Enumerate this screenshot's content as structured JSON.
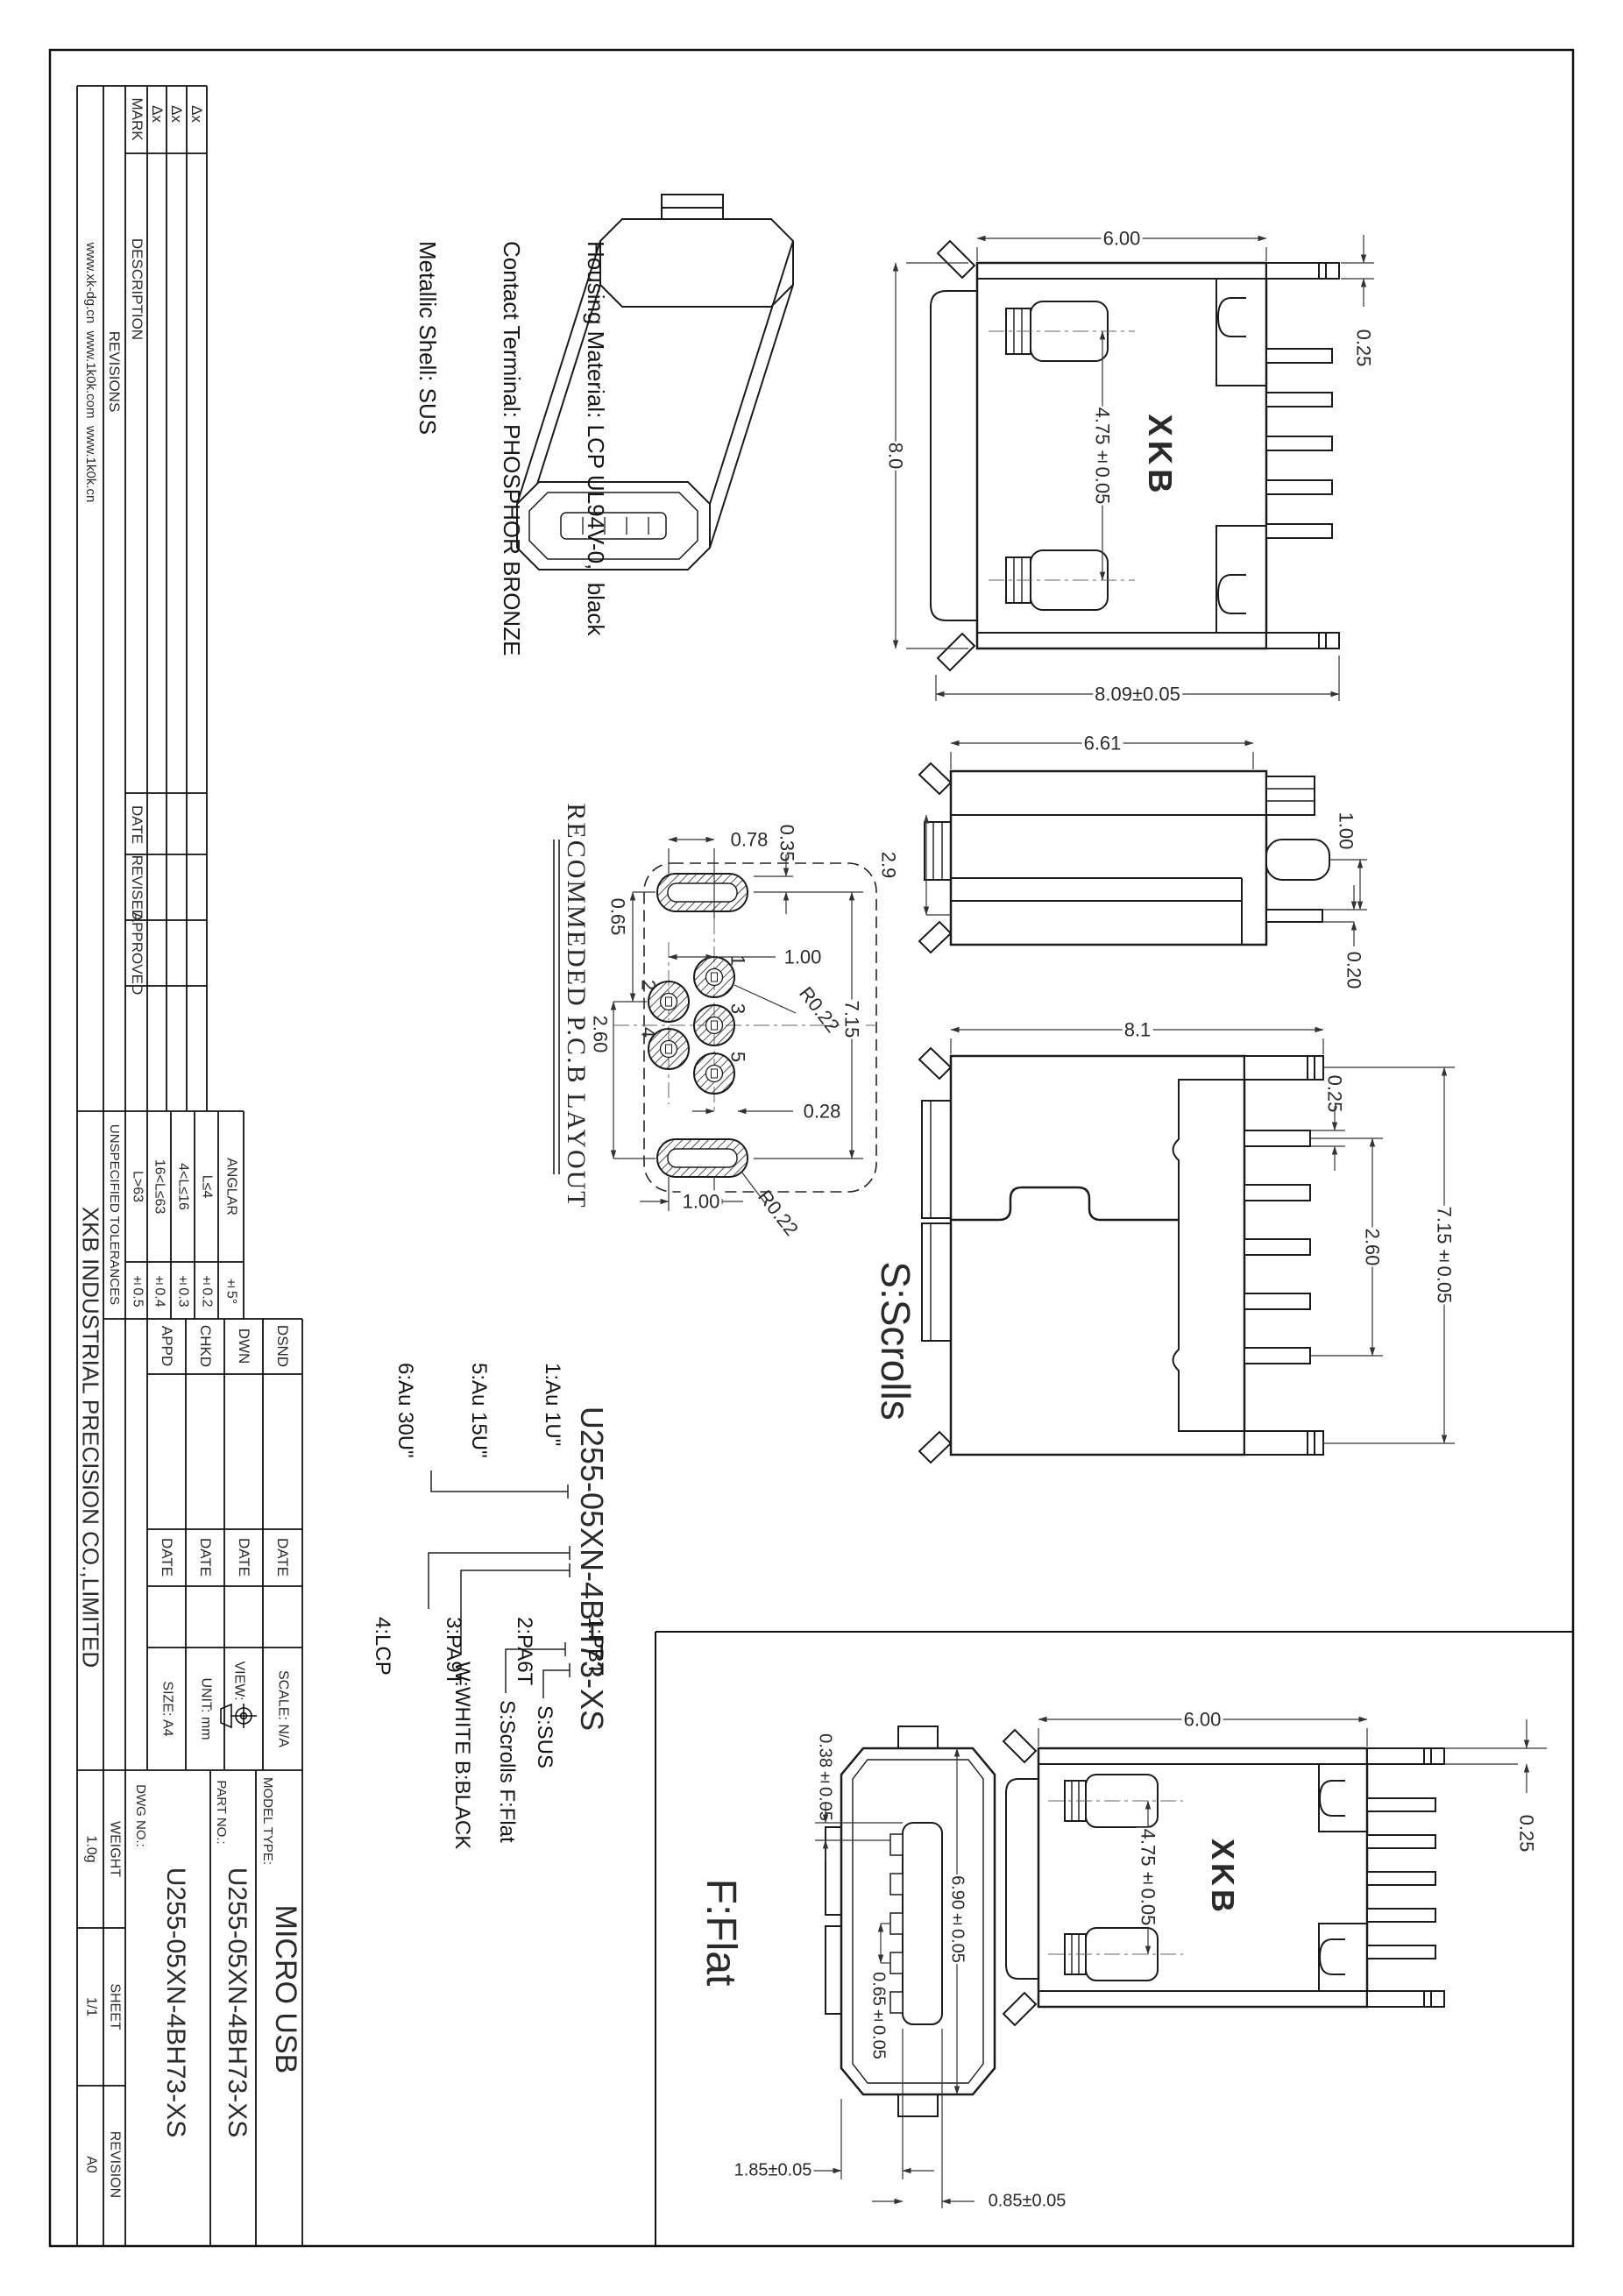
{
  "sheet": {
    "websites": "www.xk-dg.cn  www.1k0k.com  www.1k0k.cn",
    "revisions_title": "REVISIONS",
    "rev": {
      "mark": "MARK",
      "description": "DESCRIPTION",
      "date": "DATE",
      "revised": "REVISED",
      "approved": "APPROVED",
      "marks": [
        "Δx",
        "Δx",
        "Δx"
      ]
    },
    "tol": {
      "title": "UNSPECIFIED TOLERANCES",
      "l63": "L>63",
      "v63": "±0.5",
      "l1663": "16<L≤63",
      "v1663": "±0.4",
      "l416": "4<L≤16",
      "v416": "±0.3",
      "l4": "L≤4",
      "v4": "±0.2",
      "ang": "ANGLAR",
      "vang": "±5°"
    },
    "sig": {
      "dsnd": "DSND",
      "dwn": "DWN",
      "chkd": "CHKD",
      "appd": "APPD",
      "date": "DATE"
    },
    "info": {
      "scale": "SCALE: N/A",
      "view": "VIEW:",
      "unit": "UNIT: mm",
      "size": "SIZE: A4"
    },
    "tb": {
      "company": "XKB INDUSTRIAL PRECISION CO.,LIMITED",
      "model_label": "MODEL TYPE:",
      "model": "MICRO USB",
      "part_label": "PART NO.:",
      "part": "U255-05XN-4BH73-XS",
      "dwg_label": "DWG NO.:",
      "dwg": "U255-05XN-4BH73-XS",
      "weight_label": "WEIGHT",
      "weight": "1.0g",
      "sheet_label": "SHEET",
      "sheet": "1/1",
      "rev_label": "REVISION",
      "rev": "A0"
    }
  },
  "notes": {
    "l1": "Housing Material: LCP UL94V-0,  black",
    "l2": "Contact Terminal: PHOSPHOR BRONZE",
    "l3": "Metallic Shell: SUS"
  },
  "labels": {
    "scrolls": "S:Scrolls",
    "flat": "F:Flat",
    "logo": "XKB",
    "pcb_title": "RECOMMEDED P.C.B LAYOUT"
  },
  "front_view": {
    "w": "6.00",
    "h": "8.0",
    "t": "0.25",
    "pitch": "4.75±0.05",
    "w2": "8.09±0.05"
  },
  "side_view": {
    "l": "6.61",
    "h": "2.9",
    "d1": "1.00",
    "d2": "0.20"
  },
  "top_view": {
    "w": "8.1",
    "t": "0.25",
    "pitch": "2.60",
    "span": "7.15±0.05"
  },
  "pcb": {
    "d1": "0.78",
    "d2": "0.35",
    "d3": "0.65",
    "d4": "1.00",
    "d5": "2.60",
    "r1": "R0.22",
    "d6": "7.15",
    "d7": "0.28",
    "d8": "1.00",
    "r2": "R0.22",
    "p1": "1",
    "p2": "2",
    "p3": "3",
    "p4": "4",
    "p5": "5"
  },
  "flat_face": {
    "t": "0.38±0.05",
    "h": "6.90±0.05",
    "pitch": "0.65±0.05",
    "a": "1.85±0.05",
    "b": "0.85±0.05"
  },
  "flat_front": {
    "w": "6.00",
    "t": "0.25",
    "pitch": "4.75±0.05"
  },
  "breakdown": {
    "part": "U255-05XN-4BH73-XS",
    "au1": "1:Au 1U\"",
    "au5": "5:Au 15U\"",
    "au6": "6:Au 30U\"",
    "m1": "1:PBT",
    "m2": "2:PA6T",
    "m3": "3:PA9T",
    "m4": "4:LCP",
    "color": "W:WHITE B:BLACK",
    "style": "S:Scrolls F:Flat",
    "shell": "S:SUS"
  }
}
